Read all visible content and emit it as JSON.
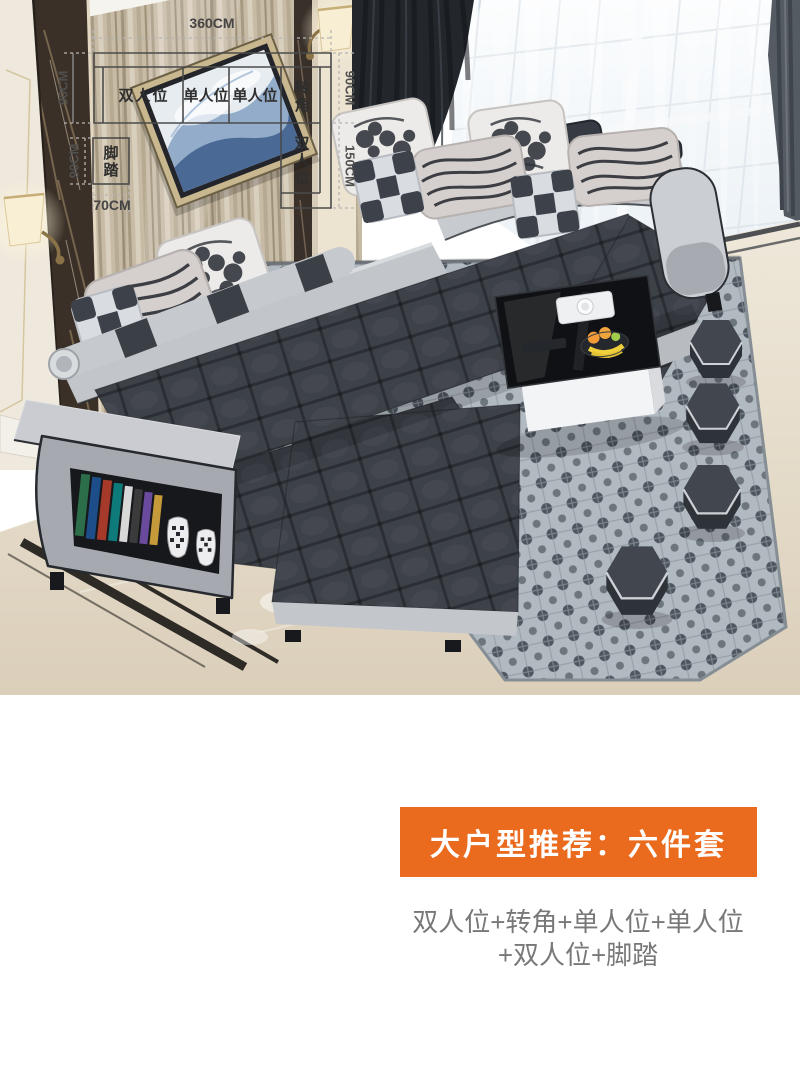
{
  "photo": {
    "description": "living room with dark grey U-shaped fabric sectional sofa, light grey trim, patterned cushions, wall art, coffee table, hexagon stools and patterned rug",
    "palette": {
      "sofa_dark": "#3d4148",
      "sofa_light": "#c6c9ce",
      "wall_wood": "#c8bba5",
      "rug": "#b2bac1",
      "floor": "#e9e1d1",
      "curtain": "#23272c"
    }
  },
  "floor_plan": {
    "dims": {
      "total_width": "360CM",
      "sofa_depth_left": "90CM",
      "sofa_depth_right": "90CM",
      "wing_length": "150CM",
      "footstool_depth": "90CM",
      "footstool_width": "70CM"
    },
    "labels": {
      "double": "双人位",
      "single": "单人位",
      "single2": "单人位",
      "corner": "转角",
      "wing_double": "双人位",
      "footstool": "脚踏"
    }
  },
  "promo": {
    "banner": "大户型推荐：六件套",
    "banner_color": "#ea6a1e",
    "combo_line1": "双人位+转角+单人位+单人位",
    "combo_line2": "+双人位+脚踏"
  }
}
